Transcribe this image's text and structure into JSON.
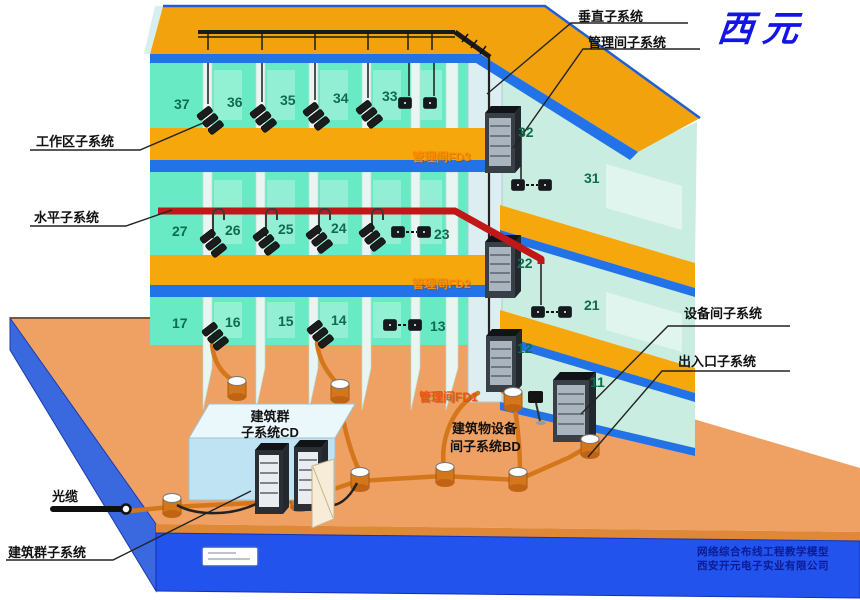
{
  "brand": {
    "name": "西元"
  },
  "annotations": {
    "vertical": "垂直子系统",
    "mgmt": "管理间子系统",
    "work": "工作区子系统",
    "horiz": "水平子系统",
    "equip": "设备间子系统",
    "entrance": "出入口子系统",
    "fiber": "光缆",
    "campus": "建筑群子系统",
    "fd3": "管理间FD3",
    "fd2": "管理间FD2",
    "fd1": "管理间FD1",
    "cd1": "建筑群",
    "cd2": "子系统CD",
    "bd1": "建筑物设备",
    "bd2": "间子系统BD"
  },
  "rooms": {
    "f3": [
      "37",
      "36",
      "35",
      "34",
      "33"
    ],
    "f2": [
      "27",
      "26",
      "25",
      "24",
      "23"
    ],
    "f1": [
      "17",
      "16",
      "15",
      "14",
      "13"
    ],
    "riser": [
      "32",
      "22",
      "12"
    ],
    "right": [
      "31",
      "21",
      "11"
    ]
  },
  "footer": {
    "line1": "网络综合布线工程教学模型",
    "line2": "西安开元电子实业有限公司"
  },
  "colors": {
    "slab_yellow": "#F5A70B",
    "slab_edge_blue": "#2273E8",
    "wall_teal": "#68EAC4",
    "ground_orange": "#EFA063",
    "platform_front_blue": "#2353ED",
    "cable_red": "#C01818",
    "conduit_orange": "#D4761A",
    "fd_label_orange": "#FF8C00",
    "brand_blue": "#1414E8",
    "footer_blue": "#0A1C96"
  }
}
